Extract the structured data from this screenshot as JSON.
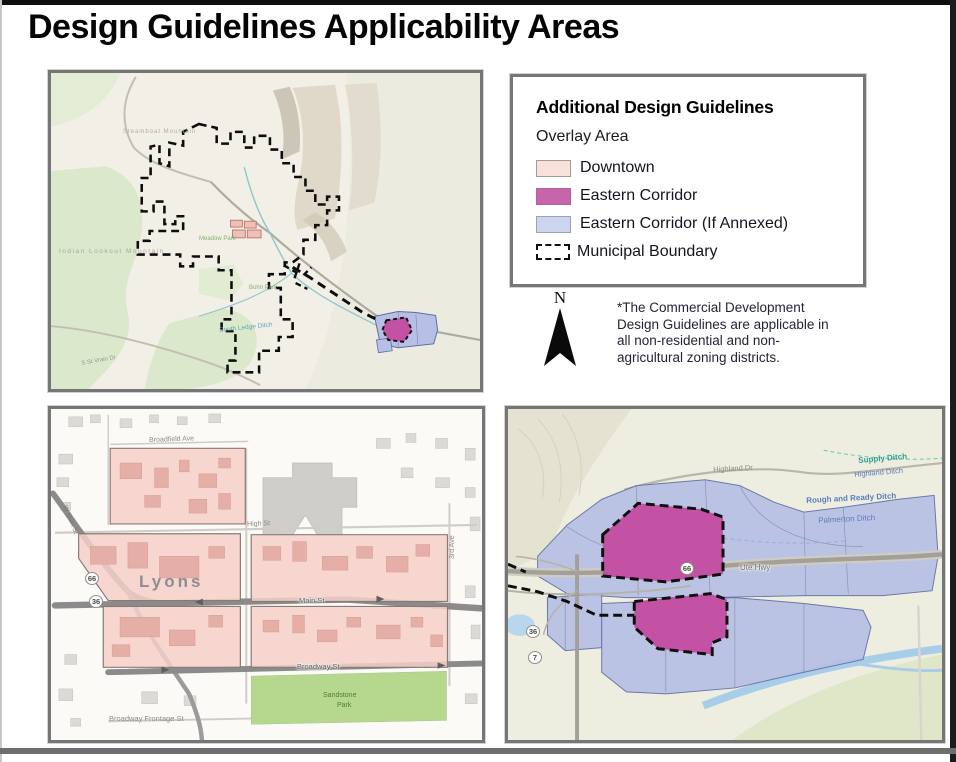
{
  "page": {
    "title": "Design Guidelines Applicability Areas"
  },
  "legend": {
    "title": "Additional Design Guidelines",
    "subtitle": "Overlay Area",
    "items": [
      {
        "name": "legend-item-downtown",
        "label": "Downtown",
        "fill": "#f9e1da",
        "border": "#a39b97",
        "kind": "swatch"
      },
      {
        "name": "legend-item-eastern-corridor",
        "label": "Eastern Corridor",
        "fill": "#c765ab",
        "border": "#b95f9e",
        "kind": "swatch"
      },
      {
        "name": "legend-item-eastern-corridor-annexed",
        "label": "Eastern Corridor (If Annexed)",
        "fill": "#ccd4ee",
        "border": "#9aa1ba",
        "kind": "swatch"
      },
      {
        "name": "legend-item-municipal-boundary",
        "label": "Municipal Boundary",
        "kind": "dashed"
      }
    ]
  },
  "north_arrow": {
    "label": "N"
  },
  "note": {
    "text": "*The Commercial Development Design Guidelines are applicable in all non-residential and non-agricultural zoning districts."
  },
  "theme": {
    "downtown_fill": "#f5cfc8",
    "eastern_corridor_fill": "#c351a4",
    "annexed_fill": "#b4bde4",
    "boundary_color": "#111111",
    "panel_border": "#767676"
  },
  "maps": {
    "overview": {
      "name": "municipal-overview-map",
      "labels": [
        {
          "name": "label-steamboat-mountain",
          "text": "Steamboat Mountain",
          "x": 72,
          "y": 56,
          "size": 6,
          "color": "#aab0a2",
          "spacing": 1
        },
        {
          "name": "label-indian-lookout-mountain",
          "text": "Indian Lookout Mountain",
          "x": 8,
          "y": 176,
          "size": 6.5,
          "color": "#a3a99c",
          "spacing": 1.5
        },
        {
          "name": "label-meadow-park",
          "text": "Meadow Park",
          "x": 148,
          "y": 163,
          "size": 6,
          "color": "#86b274"
        },
        {
          "name": "label-bohn-park",
          "text": "Bohn Park",
          "x": 198,
          "y": 212,
          "size": 6,
          "color": "#86b274"
        },
        {
          "name": "label-south-ledge-ditch",
          "text": "South Ledge Ditch",
          "x": 168,
          "y": 255,
          "size": 6.5,
          "color": "#63a8b2",
          "rotate": -6
        },
        {
          "name": "label-s-st-vrain-dr",
          "text": "S St Vrain Dr",
          "x": 30,
          "y": 288,
          "size": 6,
          "color": "#9b978b",
          "rotate": -10
        }
      ]
    },
    "downtown": {
      "name": "downtown-lyons-map",
      "labels": [
        {
          "name": "label-broadfield-ave",
          "text": "Broadfield Ave",
          "x": 98,
          "y": 28,
          "size": 7,
          "color": "#8f8c82",
          "rotate": -2
        },
        {
          "name": "label-high-st",
          "text": "High St",
          "x": 196,
          "y": 112,
          "size": 7,
          "color": "#8f8c82",
          "rotate": -2
        },
        {
          "name": "label-lyons",
          "text": "Lyons",
          "x": 88,
          "y": 164,
          "size": 17,
          "color": "#8e8e8e",
          "weight": "bold",
          "spacing": 3
        },
        {
          "name": "label-main-st",
          "text": "Main St",
          "x": 248,
          "y": 188,
          "size": 7.5,
          "color": "#5e5e5e",
          "halo": true
        },
        {
          "name": "label-broadway-st",
          "text": "Broadway St",
          "x": 246,
          "y": 254,
          "size": 7.5,
          "color": "#5e5e5e",
          "halo": true
        },
        {
          "name": "label-sandstone-park-line1",
          "text": "Sandstone",
          "x": 272,
          "y": 283,
          "size": 7,
          "color": "#4c7f35"
        },
        {
          "name": "label-sandstone-park-line2",
          "text": "Park",
          "x": 286,
          "y": 293,
          "size": 7,
          "color": "#4c7f35"
        },
        {
          "name": "label-broadway-frontage-st",
          "text": "Broadway Frontage St",
          "x": 58,
          "y": 306,
          "size": 7.5,
          "color": "#8f8c82"
        },
        {
          "name": "label-3rd-ave",
          "text": "3rd Ave",
          "x": 398,
          "y": 150,
          "size": 7,
          "color": "#8f8c82",
          "rotate": -90
        },
        {
          "name": "label-w-main-st",
          "text": "W Main St",
          "x": 16,
          "y": 96,
          "size": 6.5,
          "color": "#7d7a70",
          "rotate": 68
        },
        {
          "name": "shield-66",
          "kind": "shield",
          "text": "66",
          "x": 34,
          "y": 163
        },
        {
          "name": "shield-36",
          "kind": "shield",
          "text": "36",
          "x": 38,
          "y": 186
        }
      ]
    },
    "eastern": {
      "name": "eastern-corridor-map",
      "labels": [
        {
          "name": "label-highland-dr",
          "text": "Highland Dr",
          "x": 205,
          "y": 57,
          "size": 7.5,
          "color": "#8f8c80",
          "rotate": -3
        },
        {
          "name": "label-supply-ditch",
          "text": "Supply Ditch",
          "x": 350,
          "y": 48,
          "size": 8,
          "color": "#2f9e8f",
          "rotate": -5,
          "weight": "bold"
        },
        {
          "name": "label-highland-ditch",
          "text": "Highland Ditch",
          "x": 346,
          "y": 62,
          "size": 7.5,
          "color": "#5b7cbd",
          "rotate": -5
        },
        {
          "name": "label-rough-and-ready-ditch",
          "text": "Rough and Ready Ditch",
          "x": 298,
          "y": 88,
          "size": 8,
          "color": "#5b7cbd",
          "rotate": -3,
          "weight": "bold"
        },
        {
          "name": "label-palmerton-ditch",
          "text": "Palmerton Ditch",
          "x": 310,
          "y": 108,
          "size": 8,
          "color": "#5b7cbd",
          "rotate": -3
        },
        {
          "name": "label-ute-hwy",
          "text": "Ute Hwy",
          "x": 232,
          "y": 155,
          "size": 8,
          "color": "#6e6e68",
          "halo": true
        },
        {
          "name": "shield-66",
          "kind": "shield",
          "text": "66",
          "x": 172,
          "y": 153
        },
        {
          "name": "shield-36",
          "kind": "shield",
          "text": "36",
          "x": 18,
          "y": 216
        },
        {
          "name": "shield-7",
          "kind": "shield",
          "text": "7",
          "x": 20,
          "y": 242
        }
      ]
    }
  }
}
